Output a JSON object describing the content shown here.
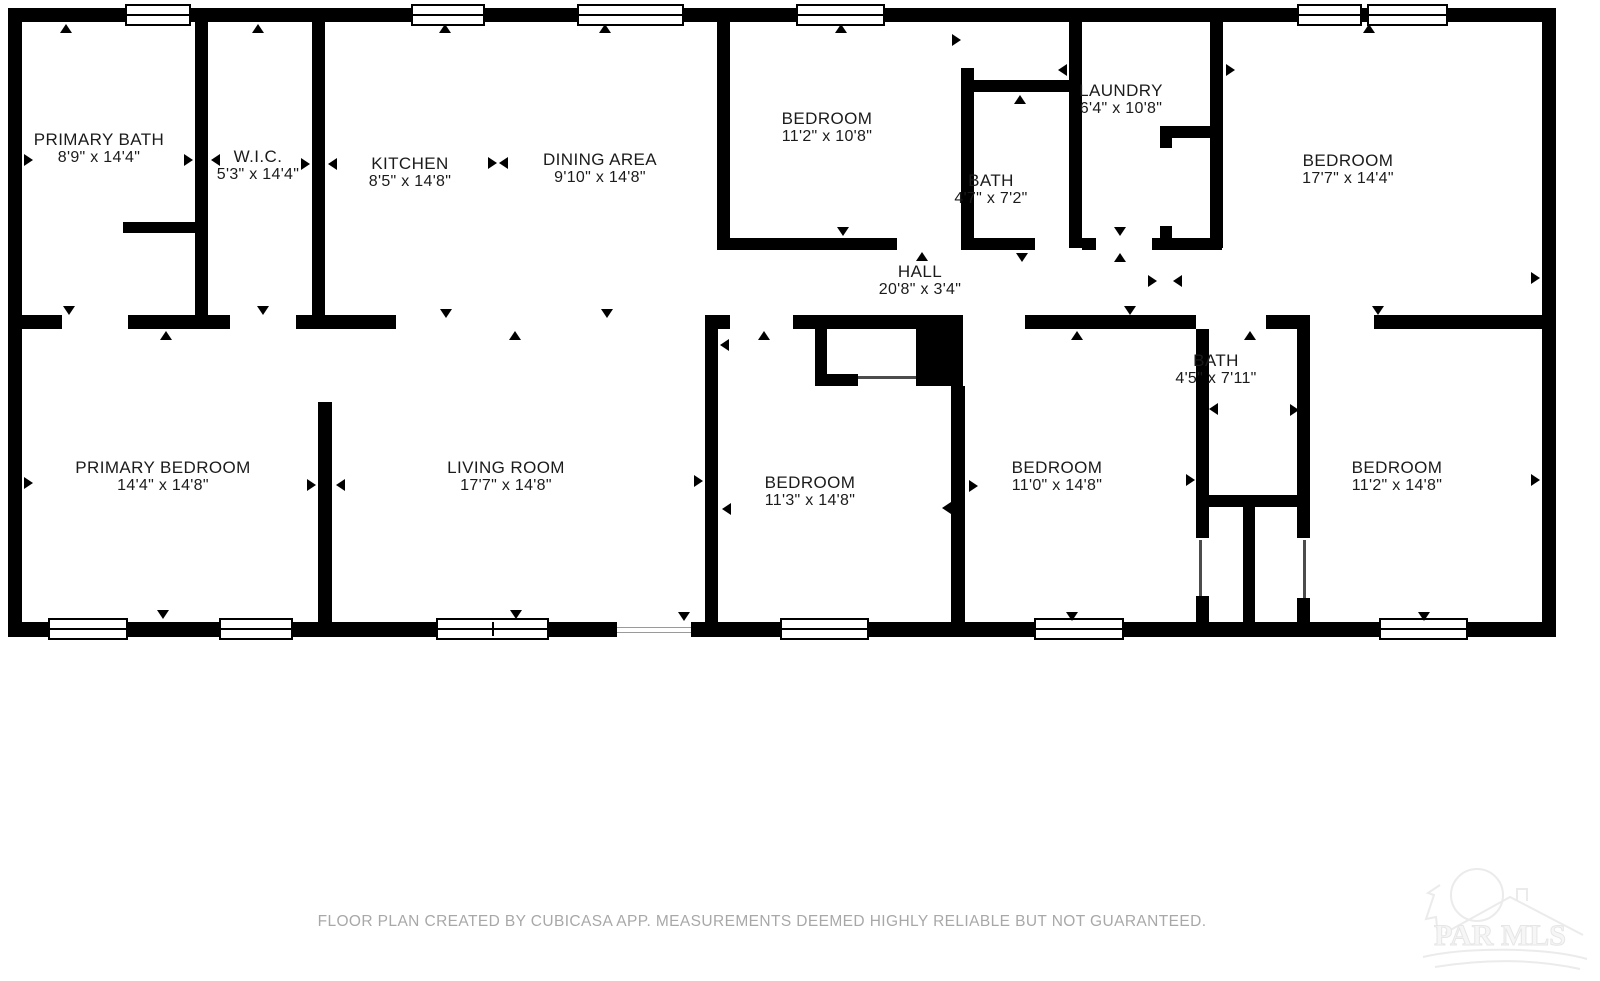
{
  "page": {
    "footer": "FLOOR PLAN CREATED BY CUBICASA APP. MEASUREMENTS DEEMED HIGHLY RELIABLE BUT NOT GUARANTEED.",
    "watermark_text": "PAR MLS"
  },
  "colors": {
    "wall": "#000000",
    "label": "#1b1b1b",
    "footer_text": "#a8a8a8",
    "watermark": "#ebebeb"
  },
  "rooms": [
    {
      "name": "PRIMARY BATH",
      "dims": "8'9\" x 14'4\"",
      "cx": 99,
      "cy": 149
    },
    {
      "name": "W.I.C.",
      "dims": "5'3\" x 14'4\"",
      "cx": 258,
      "cy": 166
    },
    {
      "name": "KITCHEN",
      "dims": "8'5\" x 14'8\"",
      "cx": 410,
      "cy": 173
    },
    {
      "name": "DINING AREA",
      "dims": "9'10\" x 14'8\"",
      "cx": 600,
      "cy": 169
    },
    {
      "name": "BEDROOM",
      "dims": "11'2\" x 10'8\"",
      "cx": 827,
      "cy": 128
    },
    {
      "name": "BATH",
      "dims": "4'7\" x 7'2\"",
      "cx": 991,
      "cy": 190
    },
    {
      "name": "LAUNDRY",
      "dims": "6'4\" x 10'8\"",
      "cx": 1121,
      "cy": 100
    },
    {
      "name": "BEDROOM",
      "dims": "17'7\" x 14'4\"",
      "cx": 1348,
      "cy": 170
    },
    {
      "name": "HALL",
      "dims": "20'8\" x 3'4\"",
      "cx": 920,
      "cy": 281
    },
    {
      "name": "PRIMARY BEDROOM",
      "dims": "14'4\" x 14'8\"",
      "cx": 163,
      "cy": 477
    },
    {
      "name": "LIVING ROOM",
      "dims": "17'7\" x 14'8\"",
      "cx": 506,
      "cy": 477
    },
    {
      "name": "BEDROOM",
      "dims": "11'3\" x 14'8\"",
      "cx": 810,
      "cy": 492
    },
    {
      "name": "BEDROOM",
      "dims": "11'0\" x 14'8\"",
      "cx": 1057,
      "cy": 477
    },
    {
      "name": "BATH",
      "dims": "4'5\" x 7'11\"",
      "cx": 1216,
      "cy": 370
    },
    {
      "name": "BEDROOM",
      "dims": "11'2\" x 14'8\"",
      "cx": 1397,
      "cy": 477
    }
  ],
  "geometry": {
    "walls": [
      [
        8,
        8,
        1548,
        14
      ],
      [
        8,
        622,
        1548,
        15
      ],
      [
        8,
        8,
        14,
        629
      ],
      [
        1542,
        8,
        14,
        629
      ],
      [
        195,
        22,
        13,
        293
      ],
      [
        312,
        22,
        13,
        293
      ],
      [
        318,
        402,
        14,
        220
      ],
      [
        717,
        22,
        13,
        226
      ],
      [
        961,
        68,
        13,
        180
      ],
      [
        1069,
        22,
        13,
        226
      ],
      [
        1210,
        8,
        13,
        240
      ],
      [
        705,
        329,
        13,
        293
      ],
      [
        951,
        386,
        14,
        236
      ],
      [
        1196,
        329,
        13,
        178
      ],
      [
        1196,
        507,
        13,
        31
      ],
      [
        1196,
        596,
        13,
        26
      ],
      [
        1297,
        329,
        13,
        209
      ],
      [
        1297,
        598,
        13,
        24
      ],
      [
        1243,
        507,
        12,
        115
      ],
      [
        815,
        329,
        12,
        57
      ],
      [
        123,
        222,
        72,
        11
      ],
      [
        974,
        80,
        95,
        12
      ],
      [
        717,
        238,
        180,
        12
      ],
      [
        961,
        238,
        74,
        12
      ],
      [
        1082,
        238,
        14,
        12
      ],
      [
        1152,
        238,
        70,
        12
      ],
      [
        1160,
        126,
        62,
        12
      ],
      [
        1160,
        126,
        12,
        22
      ],
      [
        1160,
        226,
        12,
        24
      ],
      [
        1196,
        495,
        114,
        12
      ],
      [
        815,
        374,
        43,
        12
      ],
      [
        8,
        315,
        54,
        14
      ],
      [
        128,
        315,
        102,
        14
      ],
      [
        296,
        315,
        100,
        14
      ],
      [
        705,
        315,
        25,
        14
      ],
      [
        793,
        315,
        123,
        14
      ],
      [
        916,
        315,
        47,
        71
      ],
      [
        1025,
        315,
        171,
        14
      ],
      [
        1266,
        315,
        44,
        14
      ],
      [
        1374,
        315,
        182,
        14
      ]
    ],
    "windows_top": [
      {
        "x": 125,
        "w": 66
      },
      {
        "x": 411,
        "w": 74
      },
      {
        "x": 577,
        "w": 107
      },
      {
        "x": 796,
        "w": 89
      },
      {
        "x": 1297,
        "w": 65
      },
      {
        "x": 1367,
        "w": 81
      }
    ],
    "windows_bottom": [
      {
        "x": 48,
        "w": 80
      },
      {
        "x": 219,
        "w": 74
      },
      {
        "x": 436,
        "w": 113,
        "double": true
      },
      {
        "x": 780,
        "w": 89
      },
      {
        "x": 1034,
        "w": 90
      },
      {
        "x": 1379,
        "w": 89
      }
    ],
    "openings": [
      {
        "x": 617,
        "y": 622,
        "w": 74,
        "h": 15
      }
    ],
    "door_lines": [
      [
        858,
        376,
        58,
        3
      ],
      [
        1199,
        540,
        3,
        56
      ],
      [
        1303,
        540,
        3,
        58
      ]
    ],
    "arrows": [
      {
        "x": 66,
        "y": 28,
        "d": "up"
      },
      {
        "x": 258,
        "y": 28,
        "d": "up"
      },
      {
        "x": 445,
        "y": 28,
        "d": "up"
      },
      {
        "x": 605,
        "y": 28,
        "d": "up"
      },
      {
        "x": 841,
        "y": 28,
        "d": "up"
      },
      {
        "x": 1369,
        "y": 28,
        "d": "up"
      },
      {
        "x": 28,
        "y": 160,
        "d": "right"
      },
      {
        "x": 28,
        "y": 483,
        "d": "right"
      },
      {
        "x": 188,
        "y": 160,
        "d": "right"
      },
      {
        "x": 215,
        "y": 160,
        "d": "left"
      },
      {
        "x": 305,
        "y": 164,
        "d": "right"
      },
      {
        "x": 332,
        "y": 164,
        "d": "left"
      },
      {
        "x": 492,
        "y": 163,
        "d": "right"
      },
      {
        "x": 503,
        "y": 163,
        "d": "left"
      },
      {
        "x": 69,
        "y": 310,
        "d": "down"
      },
      {
        "x": 166,
        "y": 335,
        "d": "up"
      },
      {
        "x": 263,
        "y": 310,
        "d": "down"
      },
      {
        "x": 446,
        "y": 313,
        "d": "down"
      },
      {
        "x": 515,
        "y": 335,
        "d": "up"
      },
      {
        "x": 607,
        "y": 313,
        "d": "down"
      },
      {
        "x": 764,
        "y": 335,
        "d": "up"
      },
      {
        "x": 1077,
        "y": 335,
        "d": "up"
      },
      {
        "x": 1130,
        "y": 310,
        "d": "down"
      },
      {
        "x": 1250,
        "y": 335,
        "d": "up"
      },
      {
        "x": 1378,
        "y": 310,
        "d": "down"
      },
      {
        "x": 724,
        "y": 345,
        "d": "left"
      },
      {
        "x": 710,
        "y": 385,
        "d": "right"
      },
      {
        "x": 956,
        "y": 40,
        "d": "right"
      },
      {
        "x": 1020,
        "y": 99,
        "d": "up"
      },
      {
        "x": 1062,
        "y": 70,
        "d": "left"
      },
      {
        "x": 1230,
        "y": 70,
        "d": "right"
      },
      {
        "x": 1120,
        "y": 231,
        "d": "down"
      },
      {
        "x": 1120,
        "y": 257,
        "d": "up"
      },
      {
        "x": 843,
        "y": 231,
        "d": "down"
      },
      {
        "x": 922,
        "y": 256,
        "d": "up"
      },
      {
        "x": 1022,
        "y": 257,
        "d": "down"
      },
      {
        "x": 1152,
        "y": 281,
        "d": "right"
      },
      {
        "x": 1177,
        "y": 281,
        "d": "left"
      },
      {
        "x": 1535,
        "y": 278,
        "d": "right"
      },
      {
        "x": 1535,
        "y": 480,
        "d": "right"
      },
      {
        "x": 698,
        "y": 481,
        "d": "right"
      },
      {
        "x": 726,
        "y": 509,
        "d": "left"
      },
      {
        "x": 946,
        "y": 508,
        "d": "left"
      },
      {
        "x": 973,
        "y": 486,
        "d": "right"
      },
      {
        "x": 311,
        "y": 485,
        "d": "right"
      },
      {
        "x": 340,
        "y": 485,
        "d": "left"
      },
      {
        "x": 1213,
        "y": 409,
        "d": "left"
      },
      {
        "x": 1190,
        "y": 480,
        "d": "right"
      },
      {
        "x": 1294,
        "y": 410,
        "d": "right"
      },
      {
        "x": 163,
        "y": 614,
        "d": "down"
      },
      {
        "x": 516,
        "y": 614,
        "d": "down"
      },
      {
        "x": 684,
        "y": 616,
        "d": "down"
      },
      {
        "x": 1072,
        "y": 616,
        "d": "down"
      },
      {
        "x": 1424,
        "y": 616,
        "d": "down"
      }
    ]
  }
}
